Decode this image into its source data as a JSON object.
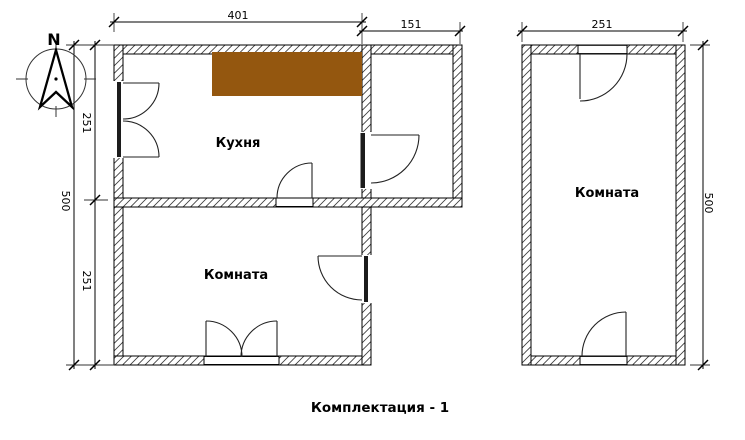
{
  "caption": "Комплектация - 1",
  "compass": {
    "north_label": "N"
  },
  "colors": {
    "kitchen_counter": "#94570F"
  },
  "left_unit": {
    "kitchen_label": "Кухня",
    "room_label": "Комната",
    "dim_width_main": "401",
    "dim_width_annex": "151",
    "dim_height_upper": "251",
    "dim_height_lower": "251",
    "dim_height_total": "500"
  },
  "right_unit": {
    "room_label": "Комната",
    "dim_width": "251",
    "dim_height": "500"
  }
}
